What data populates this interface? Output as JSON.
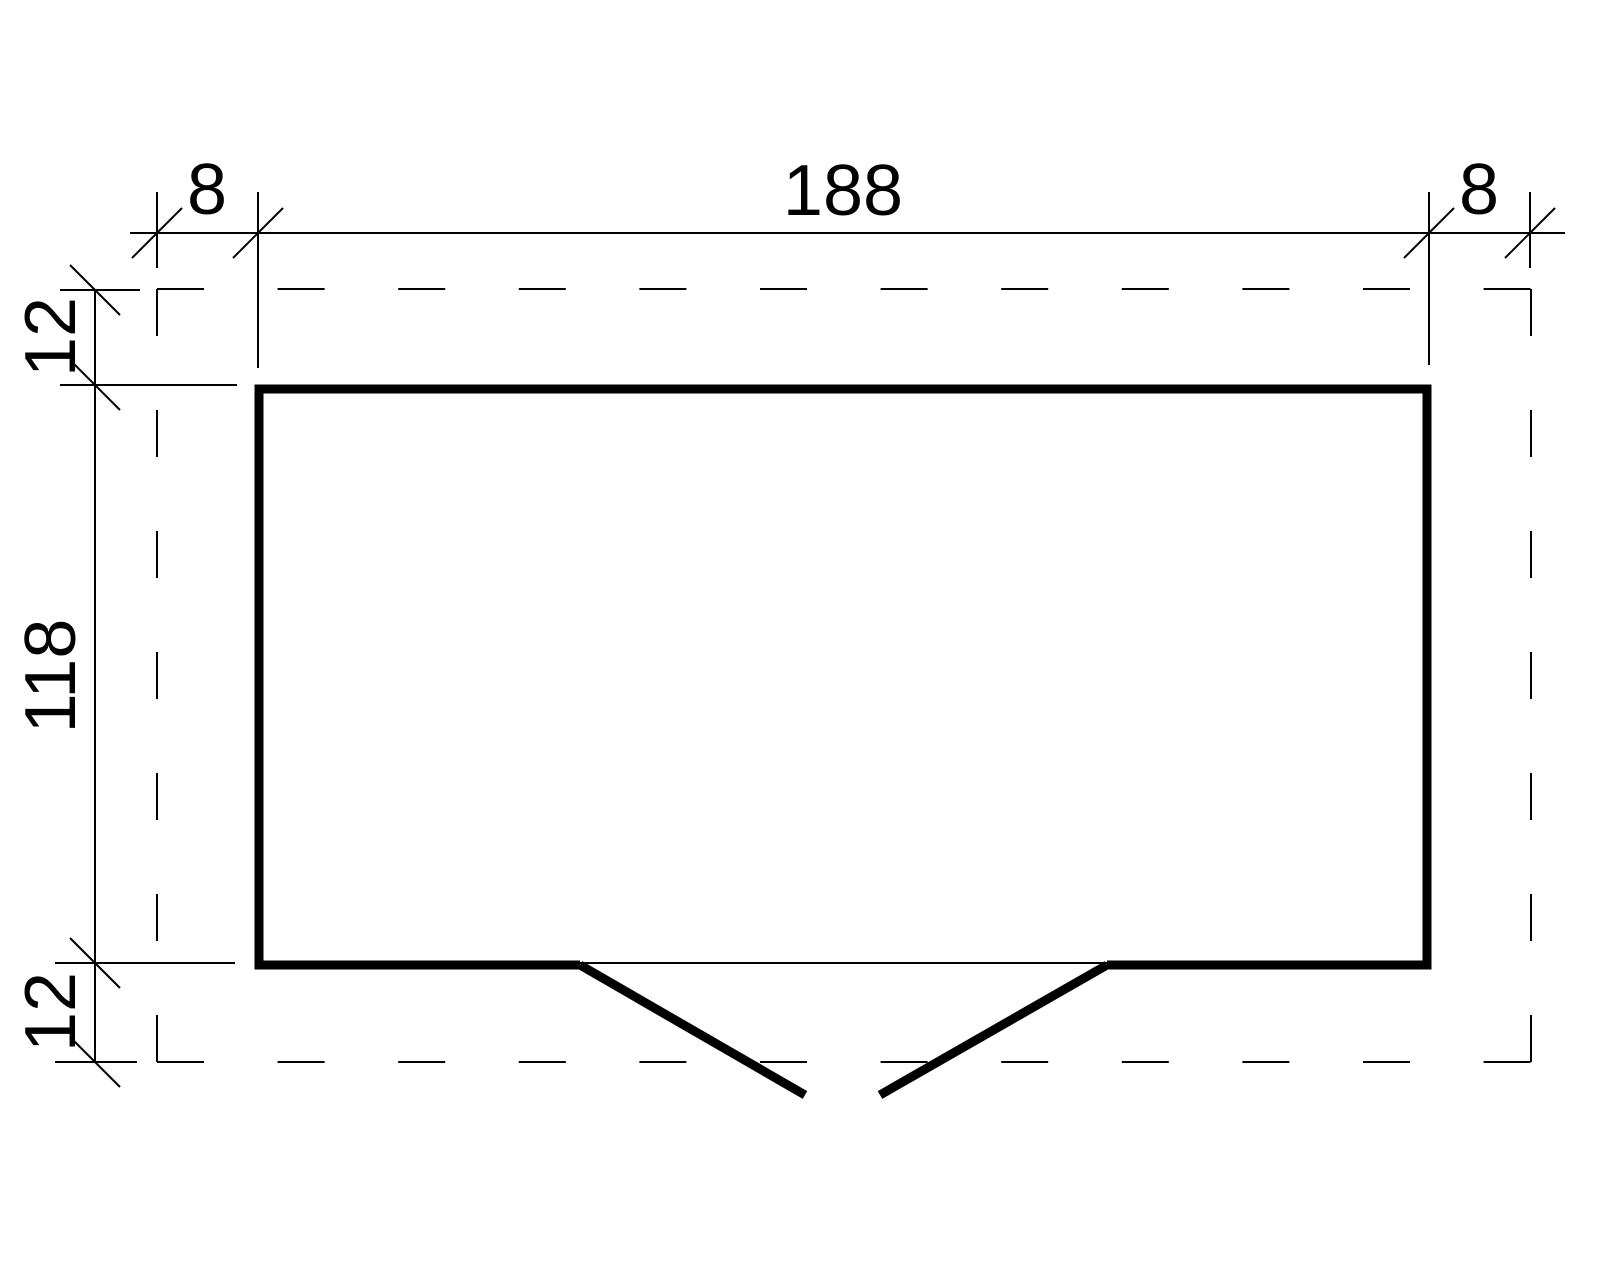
{
  "drawing": {
    "type": "floor-plan",
    "colors": {
      "line": "#000000",
      "background": "#ffffff"
    },
    "dims": {
      "top": {
        "overhang_left": "8",
        "building_width": "188",
        "overhang_right": "8"
      },
      "side": {
        "overhang_top": "12",
        "building_depth": "118",
        "overhang_bottom": "12"
      }
    }
  }
}
